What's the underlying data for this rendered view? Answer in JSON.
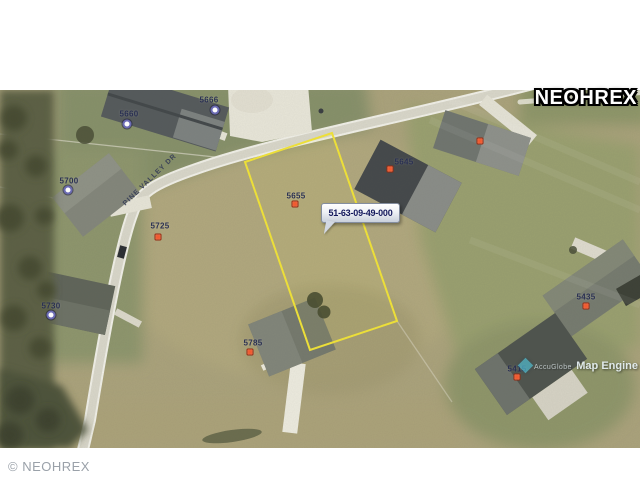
{
  "watermarks": {
    "brand_top_right": "NEOHREX",
    "copyright_bottom_left": "© NEOHREX",
    "map_engine_line1": "AccuGlobe",
    "map_engine_line2": "Map Engine"
  },
  "map": {
    "road_label": "PINE VALLEY DR",
    "parcel_id_callout": "51-63-09-49-000",
    "lot_labels": [
      {
        "text": "5660",
        "x": 129,
        "y": 24,
        "marker": "blue",
        "mx": 127,
        "my": 34
      },
      {
        "text": "5666",
        "x": 209,
        "y": 10,
        "marker": "blue",
        "mx": 215,
        "my": 20
      },
      {
        "text": "5700",
        "x": 69,
        "y": 91,
        "marker": "blue",
        "mx": 68,
        "my": 100
      },
      {
        "text": "5730",
        "x": 51,
        "y": 216,
        "marker": "blue",
        "mx": 51,
        "my": 225
      },
      {
        "text": "5725",
        "x": 160,
        "y": 136,
        "marker": "red",
        "mx": 158,
        "my": 147
      },
      {
        "text": "5655",
        "x": 296,
        "y": 106,
        "marker": "red",
        "mx": 295,
        "my": 114
      },
      {
        "text": "5645",
        "x": 404,
        "y": 72,
        "marker": "red",
        "mx": 390,
        "my": 79
      },
      {
        "text": "5785",
        "x": 253,
        "y": 253,
        "marker": "red",
        "mx": 250,
        "my": 262
      },
      {
        "text": "5435",
        "x": 586,
        "y": 207,
        "marker": "red",
        "mx": 586,
        "my": 216
      },
      {
        "text": "5415",
        "x": 517,
        "y": 279,
        "marker": "red",
        "mx": 517,
        "my": 287
      }
    ],
    "unlabeled_markers": [
      {
        "marker": "red",
        "mx": 480,
        "my": 51
      }
    ],
    "colors": {
      "parcel_outline": "#f2e438",
      "marker_red": "#f05a30",
      "marker_blue": "#6b6bb4",
      "callout_text": "#13185c"
    }
  }
}
